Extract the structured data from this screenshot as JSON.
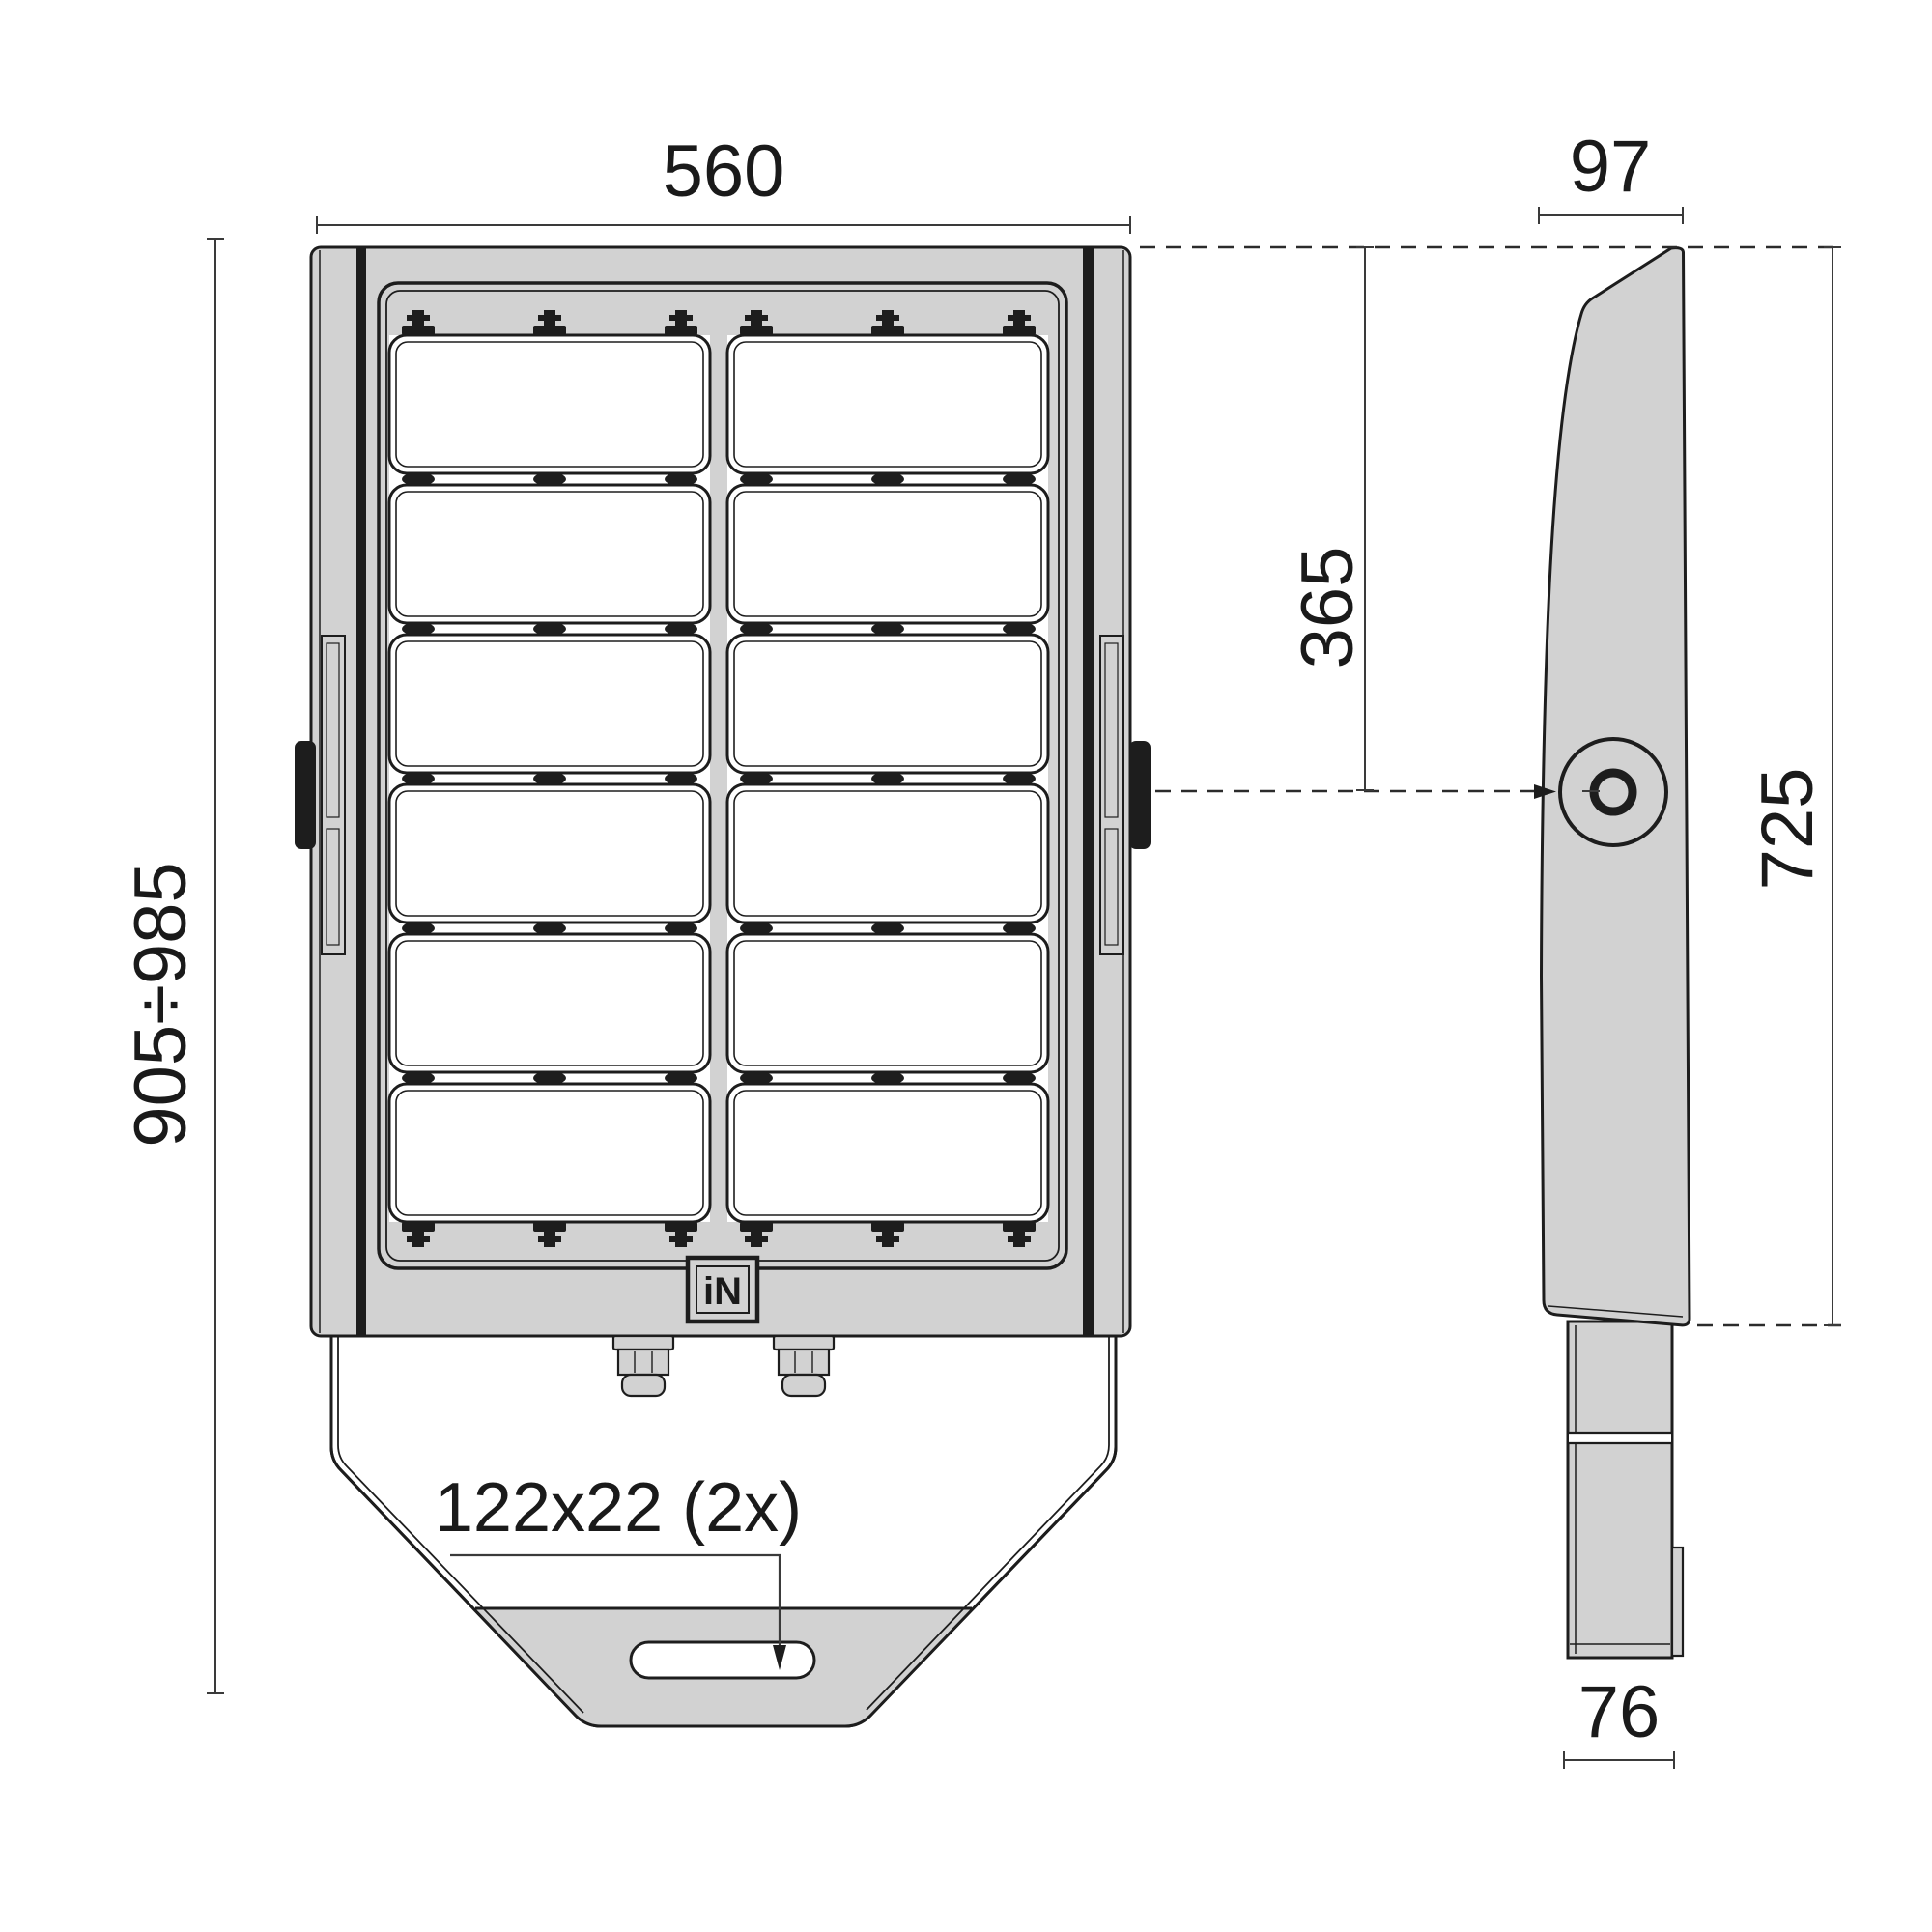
{
  "drawing": {
    "dimensions": {
      "front_width": "560",
      "front_height_range": "905÷985",
      "mounting_slot": "122x22 (2x)",
      "side_top_depth": "97",
      "top_to_pivot": "365",
      "pivot_height": "725",
      "bracket_depth": "76"
    },
    "logo": "iN",
    "colors": {
      "body_fill": "#d2d2d2",
      "outline": "#1d1d1d",
      "dimension_lines": "#3a3a3a",
      "background": "#ffffff"
    }
  }
}
